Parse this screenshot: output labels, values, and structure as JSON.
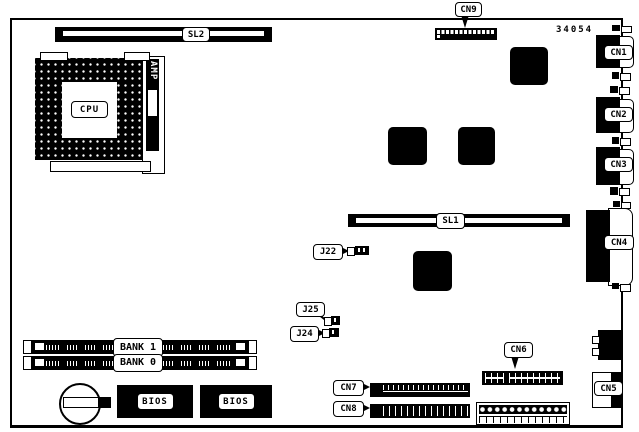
{
  "board": {
    "part_number": "34054",
    "slots": {
      "sl1": "SL1",
      "sl2": "SL2"
    },
    "cpu": {
      "label": "CPU",
      "amp": "AMP"
    },
    "memory": {
      "bank1": "BANK 1",
      "bank0": "BANK 0"
    },
    "bios": {
      "left": "BIOS",
      "right": "BIOS"
    },
    "connectors": {
      "cn1": "CN1",
      "cn2": "CN2",
      "cn3": "CN3",
      "cn4": "CN4",
      "cn5": "CN5",
      "cn6": "CN6",
      "cn7": "CN7",
      "cn8": "CN8",
      "cn9": "CN9"
    },
    "jumpers": {
      "j22": "J22",
      "j24": "J24",
      "j25": "J25"
    }
  }
}
